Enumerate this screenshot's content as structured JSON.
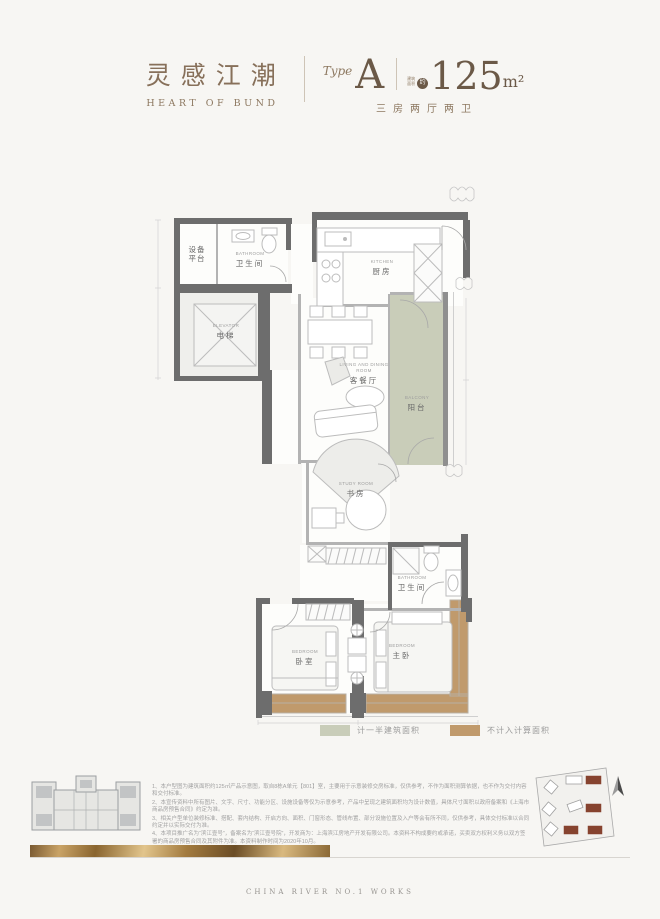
{
  "header": {
    "title_cn": "灵感江潮",
    "title_en": "HEART OF BUND",
    "type_label": "Type",
    "type_value": "A",
    "area_micro_1": "建筑",
    "area_micro_2": "面积",
    "area_circle": "约",
    "area_number": "125",
    "area_unit": "m²",
    "spec": "三房两厅两卫"
  },
  "plan": {
    "rooms": {
      "equipment": {
        "cn": "设备平台"
      },
      "bathroom1": {
        "en": "BATHROOM",
        "cn": "卫生间"
      },
      "elevator": {
        "en": "ELEVATOR",
        "cn": "电梯"
      },
      "kitchen": {
        "en": "KITCHEN",
        "cn": "厨房"
      },
      "living": {
        "en": "LIVING AND DINING ROOM",
        "cn": "客餐厅"
      },
      "balcony": {
        "en": "BALCONY",
        "cn": "阳台"
      },
      "study": {
        "en": "STUDY ROOM",
        "cn": "书房"
      },
      "bathroom2": {
        "en": "BATHROOM",
        "cn": "卫生间"
      },
      "bedroom": {
        "en": "BEDROOM",
        "cn": "卧室"
      },
      "master": {
        "en": "BEDROOM",
        "cn": "主卧"
      }
    },
    "colors": {
      "wall": "#6d6d6d",
      "half_area_green": "#c9cdb9",
      "excluded_tan": "#c09a6c",
      "title_brown": "#8a7158",
      "number_brown": "#6b5947"
    }
  },
  "legend": {
    "items": [
      {
        "label": "计一半建筑面积",
        "color": "#c9cdb9"
      },
      {
        "label": "不计入计算面积",
        "color": "#c09a6c"
      }
    ]
  },
  "notes": [
    "1、本户型图为建筑面积约125㎡产品示意图，取自8栋A单元【801】室，主要用于示意装修交房标准，仅供参考，不作为面积测算依据，也不作为交付内容和交付标准。",
    "2、本宣传资料中所有图片、文字、尺寸、功能分区、设施设备等仅为示意参考，产品中呈现之建筑面积均为设计数值，具体尺寸面积以政府备案和《上海市商品房预售合同》约定为准。",
    "3、相关户型单位装修标准、搭配、套内结构、开启方向、面积、门窗形态、管线布置、部分设施位置及入户等会有所不同，仅供参考，具体交付标准以合同约定并以实际交付为准。",
    "4、本项目推广名为“滨江壹号”，备案名为“滨江壹号院”，开发商为：上海滨江房地产开发有限公司。本资料不构成要约或承诺，买卖双方权利义务以双方签署的商品房预售合同及其附件为准。本资料制作时间为2020年10月。"
  ],
  "footer": {
    "text": "CHINA RIVER NO.1 WORKS"
  }
}
